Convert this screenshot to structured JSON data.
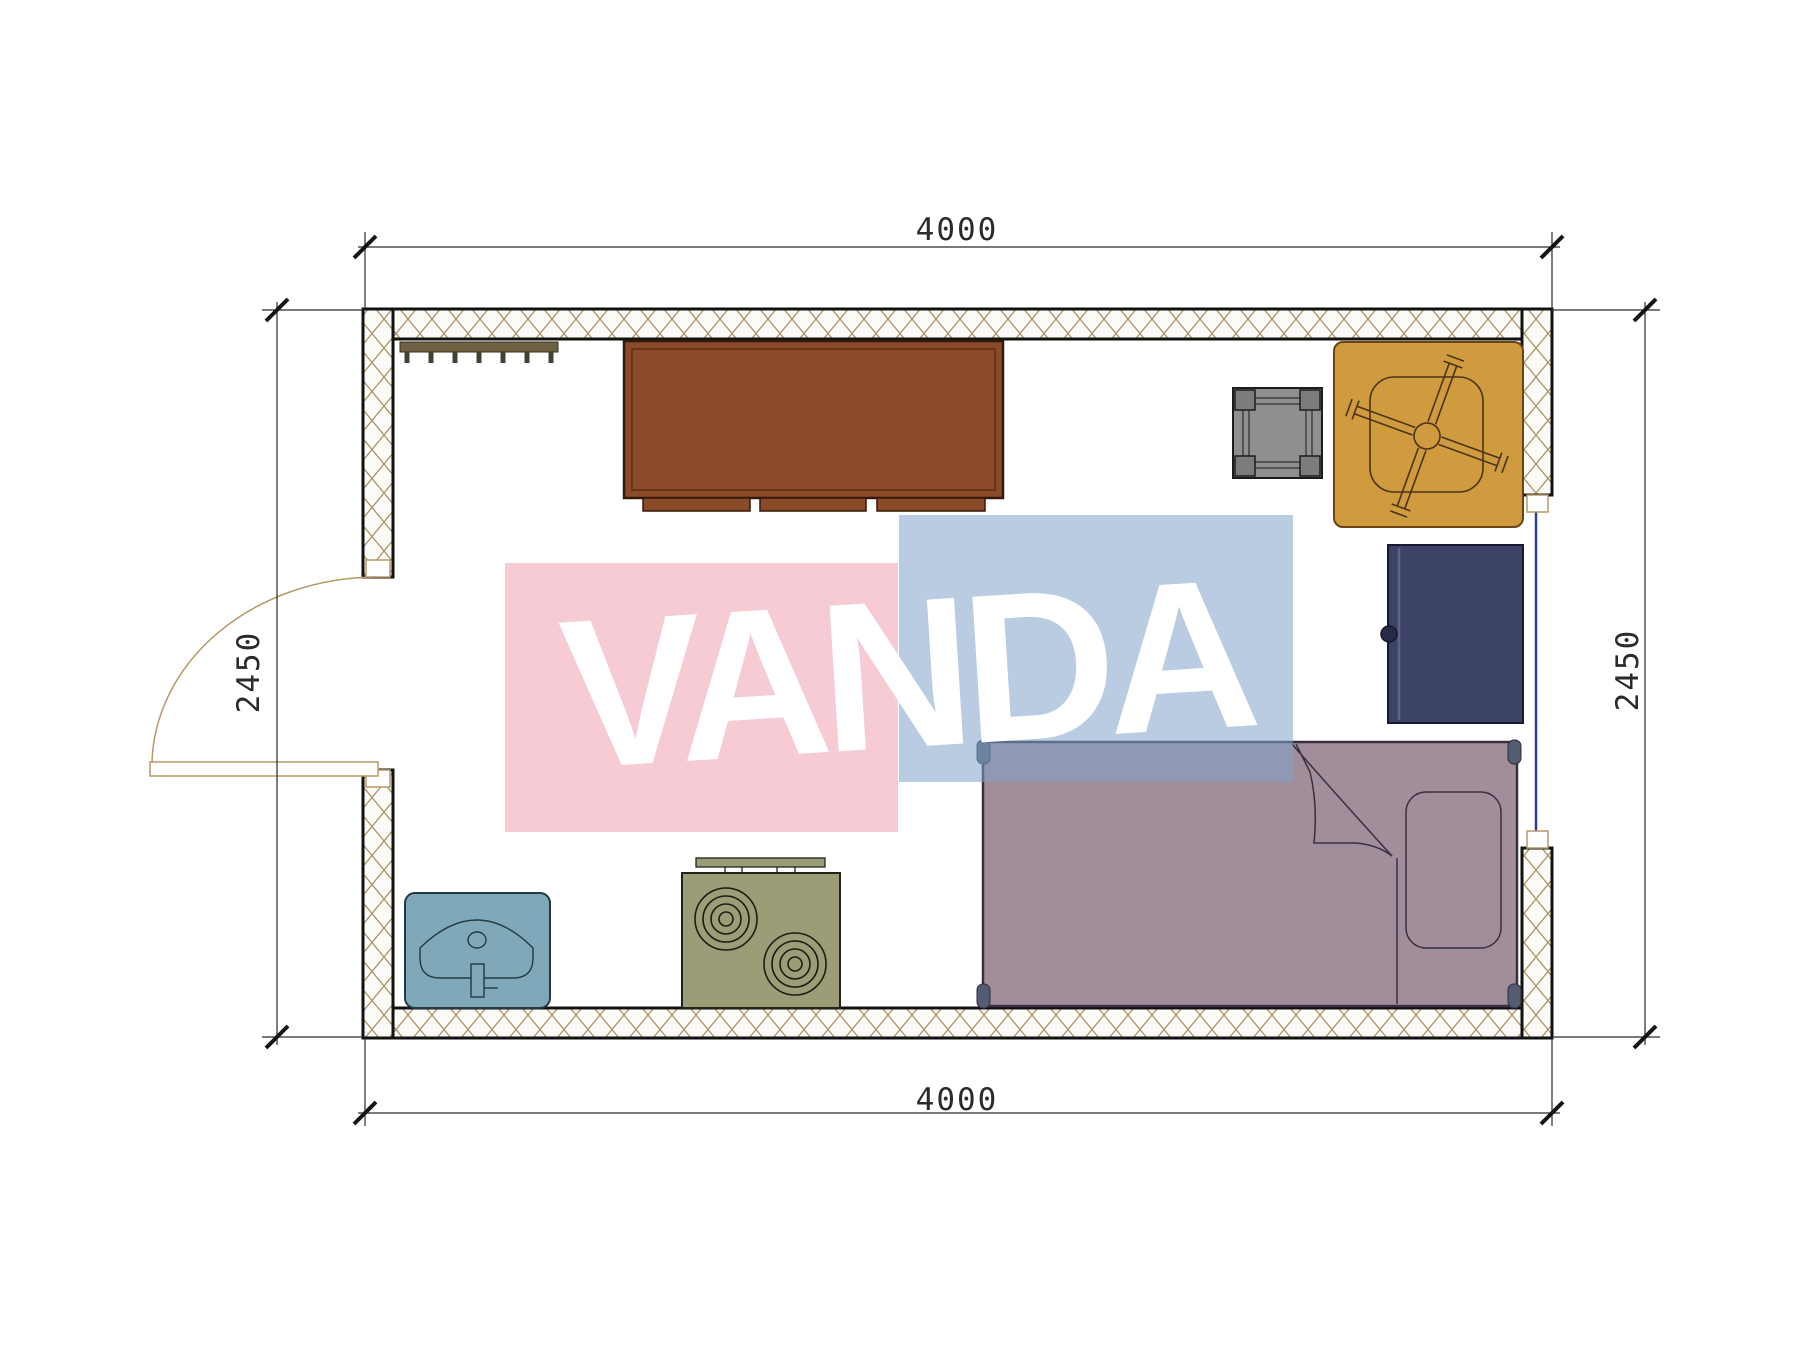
{
  "watermark": {
    "text": "VANDA",
    "pink_color": "#f6c3cd",
    "blue_color": "#bfd0e4",
    "text_color": "#ffffff"
  },
  "dimensions": {
    "top": "4000",
    "bottom": "4000",
    "left": "2450",
    "right": "2450"
  },
  "objects": [
    "coat-rack",
    "wardrobe",
    "side-table",
    "table-with-chair",
    "cabinet",
    "bed",
    "sink",
    "stove",
    "door",
    "window"
  ],
  "colors": {
    "wall_line": "#121212",
    "wall_hatch": "#ab9263",
    "wardrobe": "#8c4b28",
    "coat_rack": "#6d6142",
    "side_table": "#8f8f8f",
    "table": "#d09a3e",
    "cabinet": "#3c4366",
    "bed": "#a28e9a",
    "sink": "#7fa9b8",
    "stove": "#9c9c76",
    "door": "#b59a66",
    "window": "#2f3a96",
    "dimension_text": "#2b2b2b"
  }
}
